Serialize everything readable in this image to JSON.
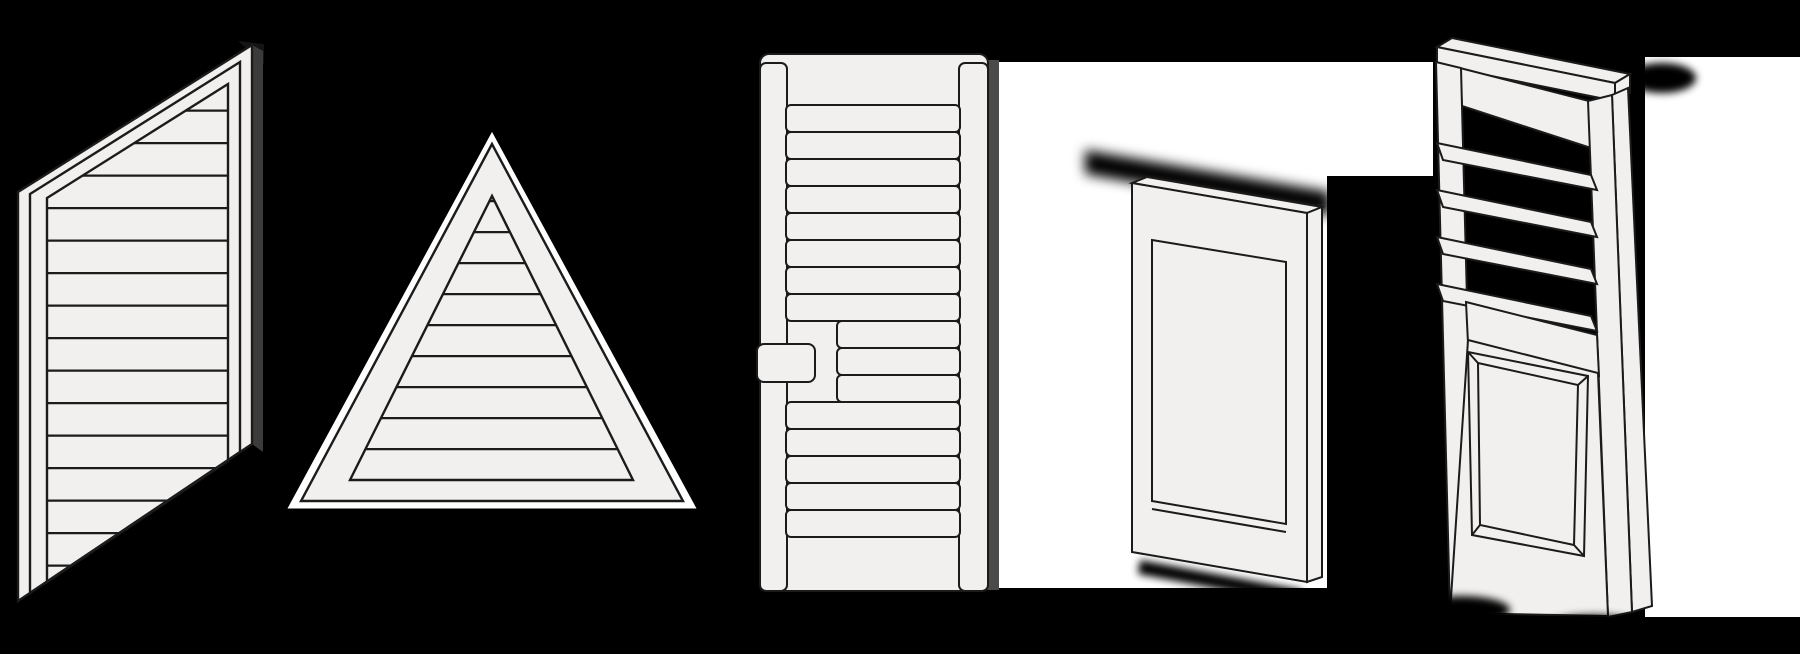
{
  "canvas": {
    "width": 1800,
    "height": 654,
    "background": "#000000"
  },
  "colors": {
    "background": "#000000",
    "backdrop_white": "#ffffff",
    "panel_fill": "#f1f0ee",
    "outline": "#1b1b1b",
    "depth_grey": "#4a4a4a",
    "depth_dark": "#3b3b3b",
    "cap_black": "#141414"
  },
  "illustrations": [
    {
      "id": "angled-louvered-shutter",
      "icon": "angled-louvered-shutter-illustration"
    },
    {
      "id": "triangle-louvered-shutter",
      "icon": "triangle-louvered-shutter-illustration"
    },
    {
      "id": "stepped-divider-louvered-shutter",
      "icon": "stepped-divider-louvered-shutter-illustration"
    },
    {
      "id": "flat-panel-shutter",
      "icon": "flat-panel-shutter-illustration"
    },
    {
      "id": "open-louver-raised-panel-shutter",
      "icon": "open-louver-raised-panel-shutter-illustration"
    }
  ]
}
